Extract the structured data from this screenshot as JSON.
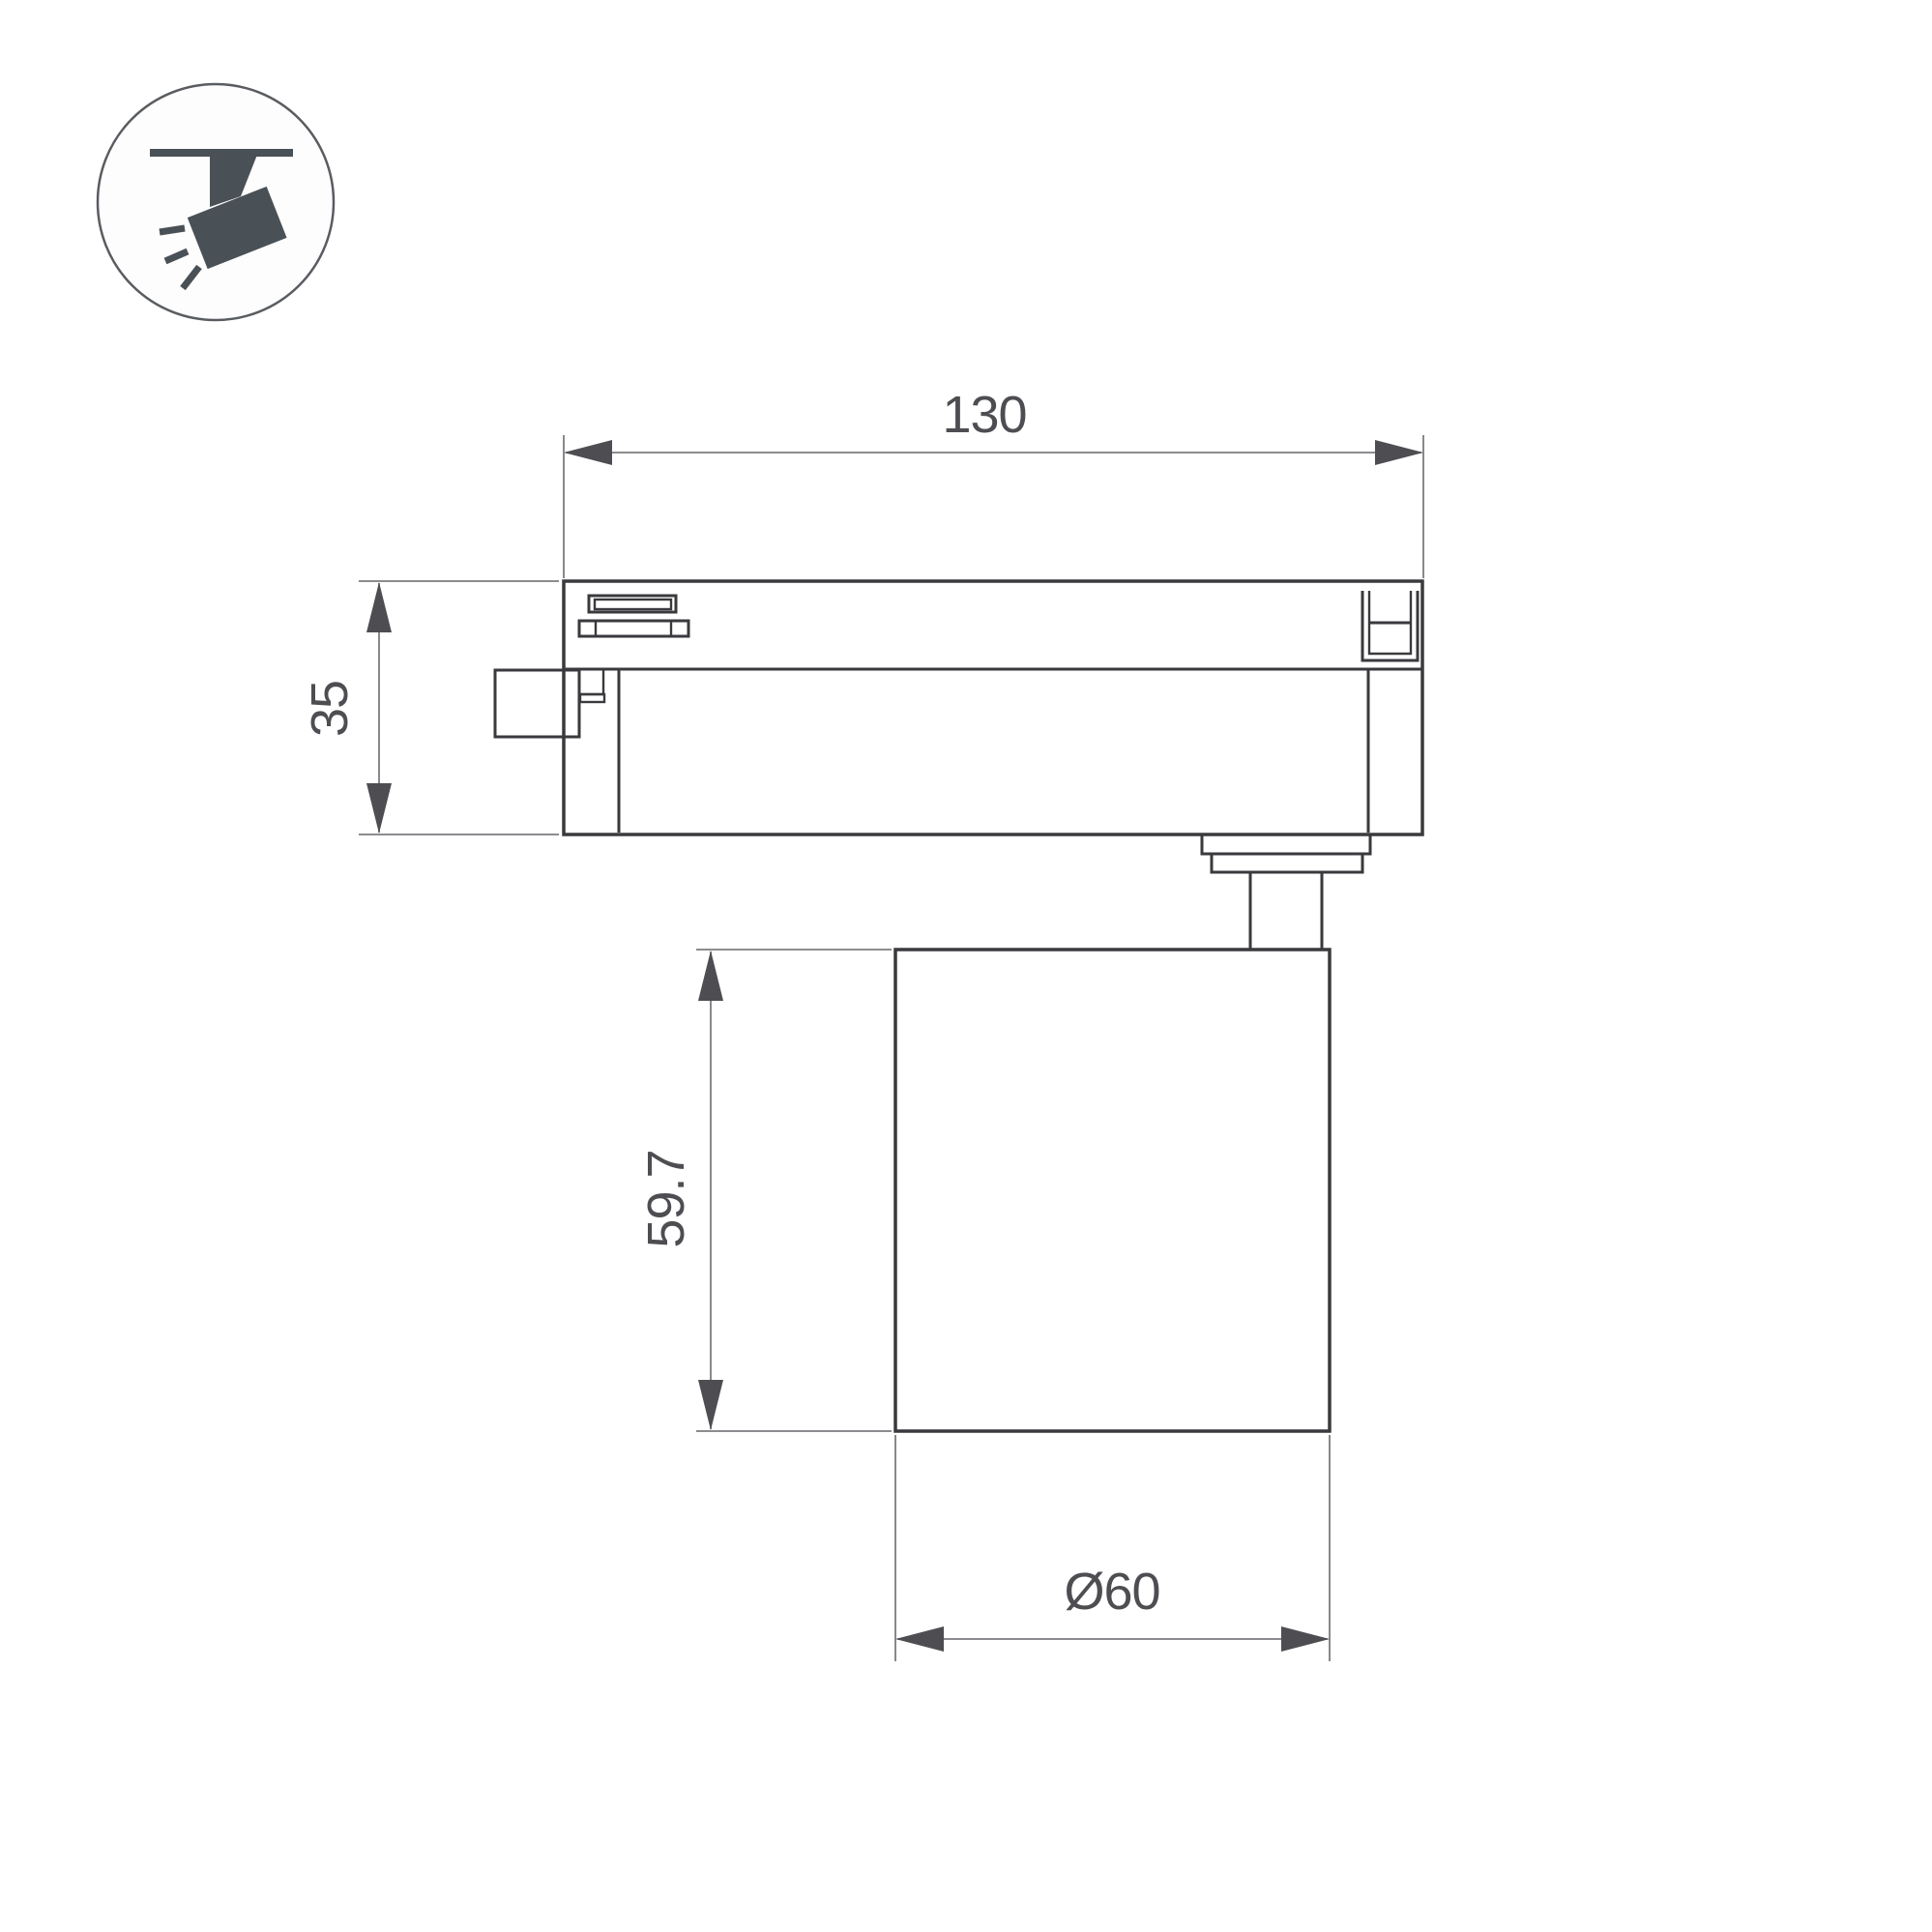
{
  "page": {
    "background_color": "#ffffff"
  },
  "badge": {
    "icon": "track-spotlight-icon",
    "circle_color": "#595c60",
    "glyph_color": "#495056"
  },
  "drawing": {
    "outline_color": "#3a3a3e",
    "dimension_color": "#4d4d52",
    "extension_line_color": "#7c7c80",
    "dimensions": {
      "adapter_length": "130",
      "adapter_height": "35",
      "body_height": "59.7",
      "body_diameter": "Ø60"
    }
  }
}
